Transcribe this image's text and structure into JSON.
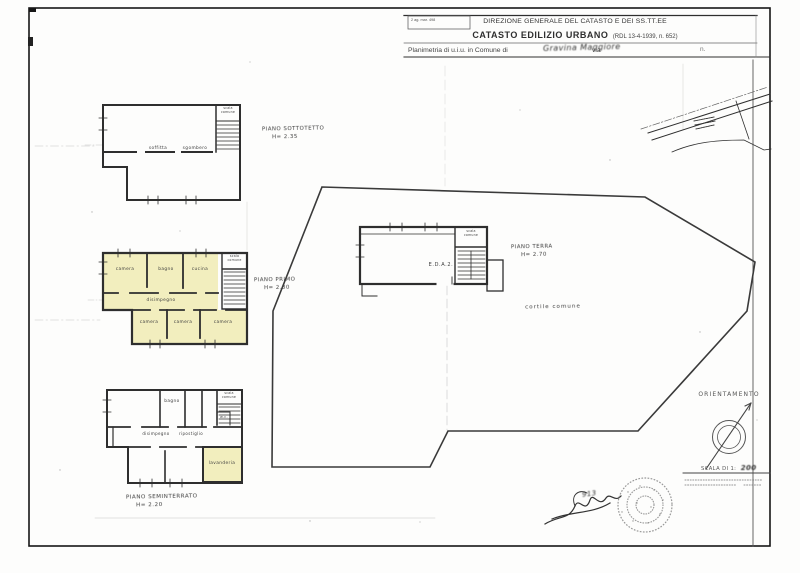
{
  "header": {
    "stamp_text": "2 ag. mar. 498",
    "agency": "DIREZIONE GENERALE DEL CATASTO E DEI SS.TT.EE",
    "register": "CATASTO EDILIZIO URBANO",
    "register_ref": "(RDL 13-4-1939, n. 652)",
    "planimetria_prefix": "Planimetria di u.i.u. in Comune di",
    "comune_value": "Gravina Maggiore",
    "via_label": "via",
    "number_label": "n."
  },
  "floors": {
    "sottotetto": {
      "title": "PIANO SOTTOTETTO",
      "height": "H= 2.35",
      "room_main": "soffitta",
      "room_secondary": "sgombero",
      "stair": "scala comune"
    },
    "primo": {
      "title": "PIANO PRIMO",
      "height": "H= 2.80",
      "rooms": {
        "r1": "camera",
        "r2": "bagno",
        "r3": "cucina",
        "hall": "disimpegno",
        "r4": "camera",
        "r5": "camera",
        "r6": "camera"
      },
      "stair": "scala comune"
    },
    "terra": {
      "title": "PIANO TERRA",
      "height": "H= 2.70",
      "unit_ref": "E.D.A.2.",
      "courtyard": "cortile comune",
      "stair": "scala comune"
    },
    "seminterrato": {
      "title": "PIANO SEMINTERRATO",
      "height": "H= 2.20",
      "rooms": {
        "bath": "bagno",
        "hall": "disimpegno",
        "storage": "ripostiglio",
        "wc": "w.c.",
        "laundry": "lavanderia"
      },
      "stair": "scala comune"
    }
  },
  "compass": {
    "title": "ORIENTAMENTO",
    "scale_prefix": "SCALA DI 1:",
    "scale_value": "200"
  },
  "signature": {
    "number": "913"
  },
  "colors": {
    "highlight": "#f1edbb",
    "ink": "#2e2e2e"
  }
}
